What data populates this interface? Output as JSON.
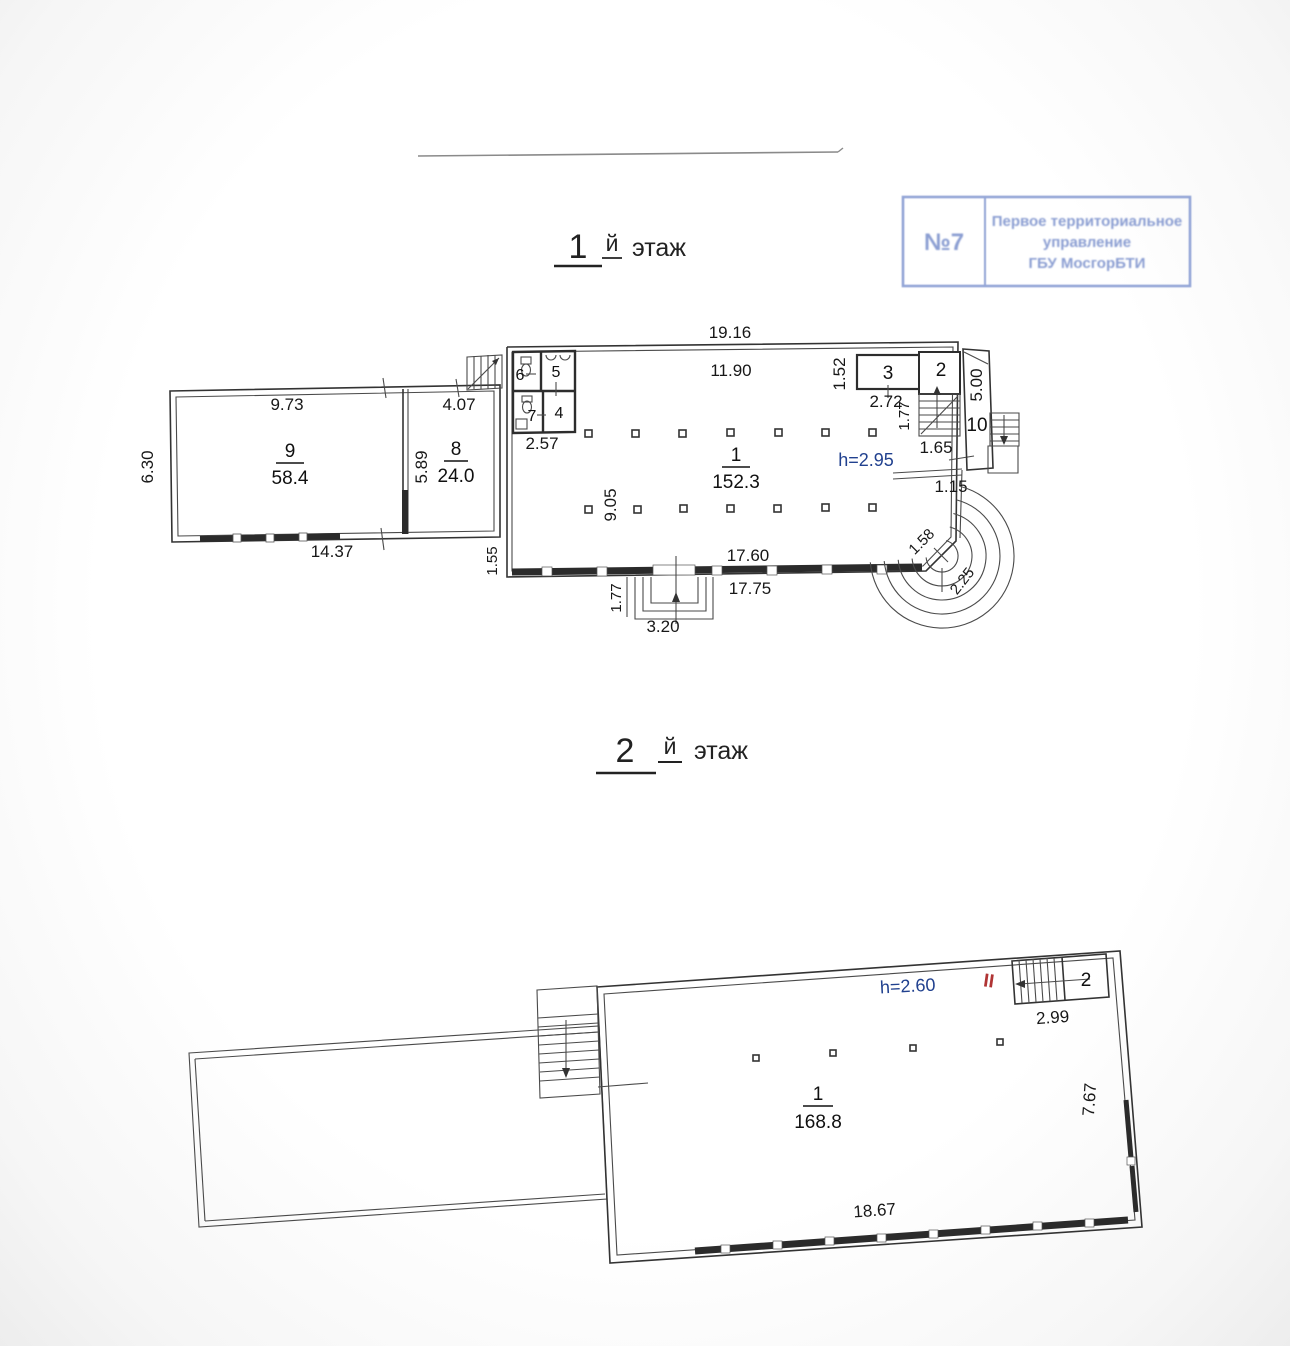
{
  "stamp": {
    "number": "№7",
    "line1": "Первое территориальное",
    "line2": "управление",
    "line3": "ГБУ МосгорБТИ",
    "color": "#8b9ed2"
  },
  "floor1": {
    "title": {
      "num": "1",
      "suffix": "й",
      "word": "этаж"
    },
    "height_note": "h=2.95",
    "rooms": {
      "r1": {
        "num": "1",
        "area": "152.3"
      },
      "r9": {
        "num": "9",
        "area": "58.4"
      },
      "r8": {
        "num": "8",
        "area": "24.0"
      },
      "r2": {
        "num": "2"
      },
      "r3": {
        "num": "3"
      },
      "r4": {
        "num": "4"
      },
      "r5": {
        "num": "5"
      },
      "r6": {
        "num": "6"
      },
      "r7": {
        "num": "7"
      },
      "r10": {
        "num": "10"
      }
    },
    "dims": {
      "d1916": "19.16",
      "d1190": "11.90",
      "d152": "1.52",
      "d272": "2.72",
      "d177s": "1.77",
      "d165": "1.65",
      "d500": "5.00",
      "d115": "1.15",
      "d973": "9.73",
      "d630": "6.30",
      "d407": "4.07",
      "d589": "5.89",
      "d257": "2.57",
      "d1437": "14.37",
      "d155": "1.55",
      "d905": "9.05",
      "d1760": "17.60",
      "d1775": "17.75",
      "d177p": "1.77",
      "d320": "3.20",
      "d158": "1.58",
      "d225": "2.25"
    }
  },
  "floor2": {
    "title": {
      "num": "2",
      "suffix": "й",
      "word": "этаж"
    },
    "height_note": "h=2.60",
    "section_mark": "II",
    "rooms": {
      "r1": {
        "num": "1",
        "area": "168.8"
      },
      "r2": {
        "num": "2"
      }
    },
    "dims": {
      "d299": "2.99",
      "d767": "7.67",
      "d1867": "18.67"
    }
  },
  "colors": {
    "height_note": "#21418f",
    "section_mark": "#b03434",
    "stamp": "#8b9ed2"
  }
}
